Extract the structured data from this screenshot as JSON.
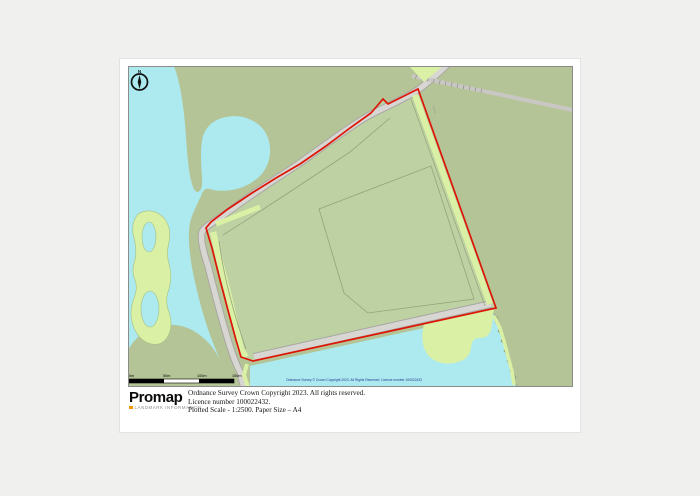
{
  "map": {
    "compass": {
      "label": "N"
    },
    "scale_bar": {
      "labels": [
        "0m",
        "50m",
        "100m",
        "150m"
      ]
    },
    "inline_copyright": "Ordnance Survey © Crown Copyright 2023. All Rights Reserved. Licence number 100022432",
    "track_label": "Track",
    "colors": {
      "water": "#aceaf0",
      "land": "#b5c496",
      "parcel": "#bdd1a3",
      "vegetation_strip": "#daf0a5",
      "road_fill": "#d8d6d2",
      "road_casing": "#a9a7a3",
      "boundary_red": "#dd1505",
      "field_line": "#96a37b"
    }
  },
  "footer": {
    "logo": "Promap",
    "logo_caption": "LANDMARK INFORMATION",
    "lines": [
      "Ordnance Survey Crown Copyright 2023. All rights reserved.",
      "Licence number 100022432.",
      "Plotted Scale - 1:2500. Paper Size – A4"
    ]
  }
}
